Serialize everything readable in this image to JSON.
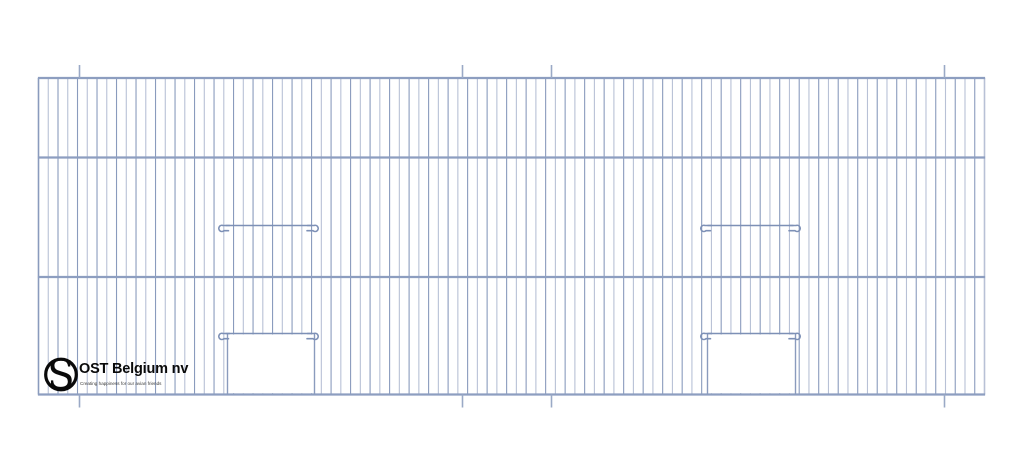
{
  "brand": {
    "name": "OST Belgium nv",
    "tagline": "Creating happiness for our avian friends",
    "logo_icon": "s-in-circle-logo",
    "logo_letter": "S"
  },
  "drawing": {
    "description": "Technical line drawing of a wire-mesh cage front panel with two sliding-door openings",
    "background": "#ffffff",
    "colors": {
      "wire_dark": "#8a9bbd",
      "wire_light": "#b8c1d6",
      "rail": "#8d9ec0",
      "hook": "#7d90b6",
      "tick": "#9aa9c6",
      "logo": "#0a0a0a",
      "white": "#ffffff"
    },
    "panel": {
      "x_left": 38.5,
      "x_right": 984.5,
      "y_top": 78,
      "y_bottom": 394.5,
      "horizontal_rails_y": [
        78,
        157.5,
        277,
        394.5
      ],
      "wire_gaps": 97,
      "tick_xs": [
        79.5,
        462.5,
        551.5,
        944.5
      ],
      "tick_len": 13
    },
    "doors": [
      {
        "bar_x1": 219.5,
        "bar_x2": 317.5,
        "upper_bar_y": 225.5,
        "opening_top_y": 333.5,
        "opening_x1": 227.5,
        "opening_x2": 314.5
      },
      {
        "bar_x1": 701.5,
        "bar_x2": 799.5,
        "upper_bar_y": 225.5,
        "opening_top_y": 333.5,
        "opening_x1": 707.5,
        "opening_x2": 795.5
      }
    ]
  }
}
